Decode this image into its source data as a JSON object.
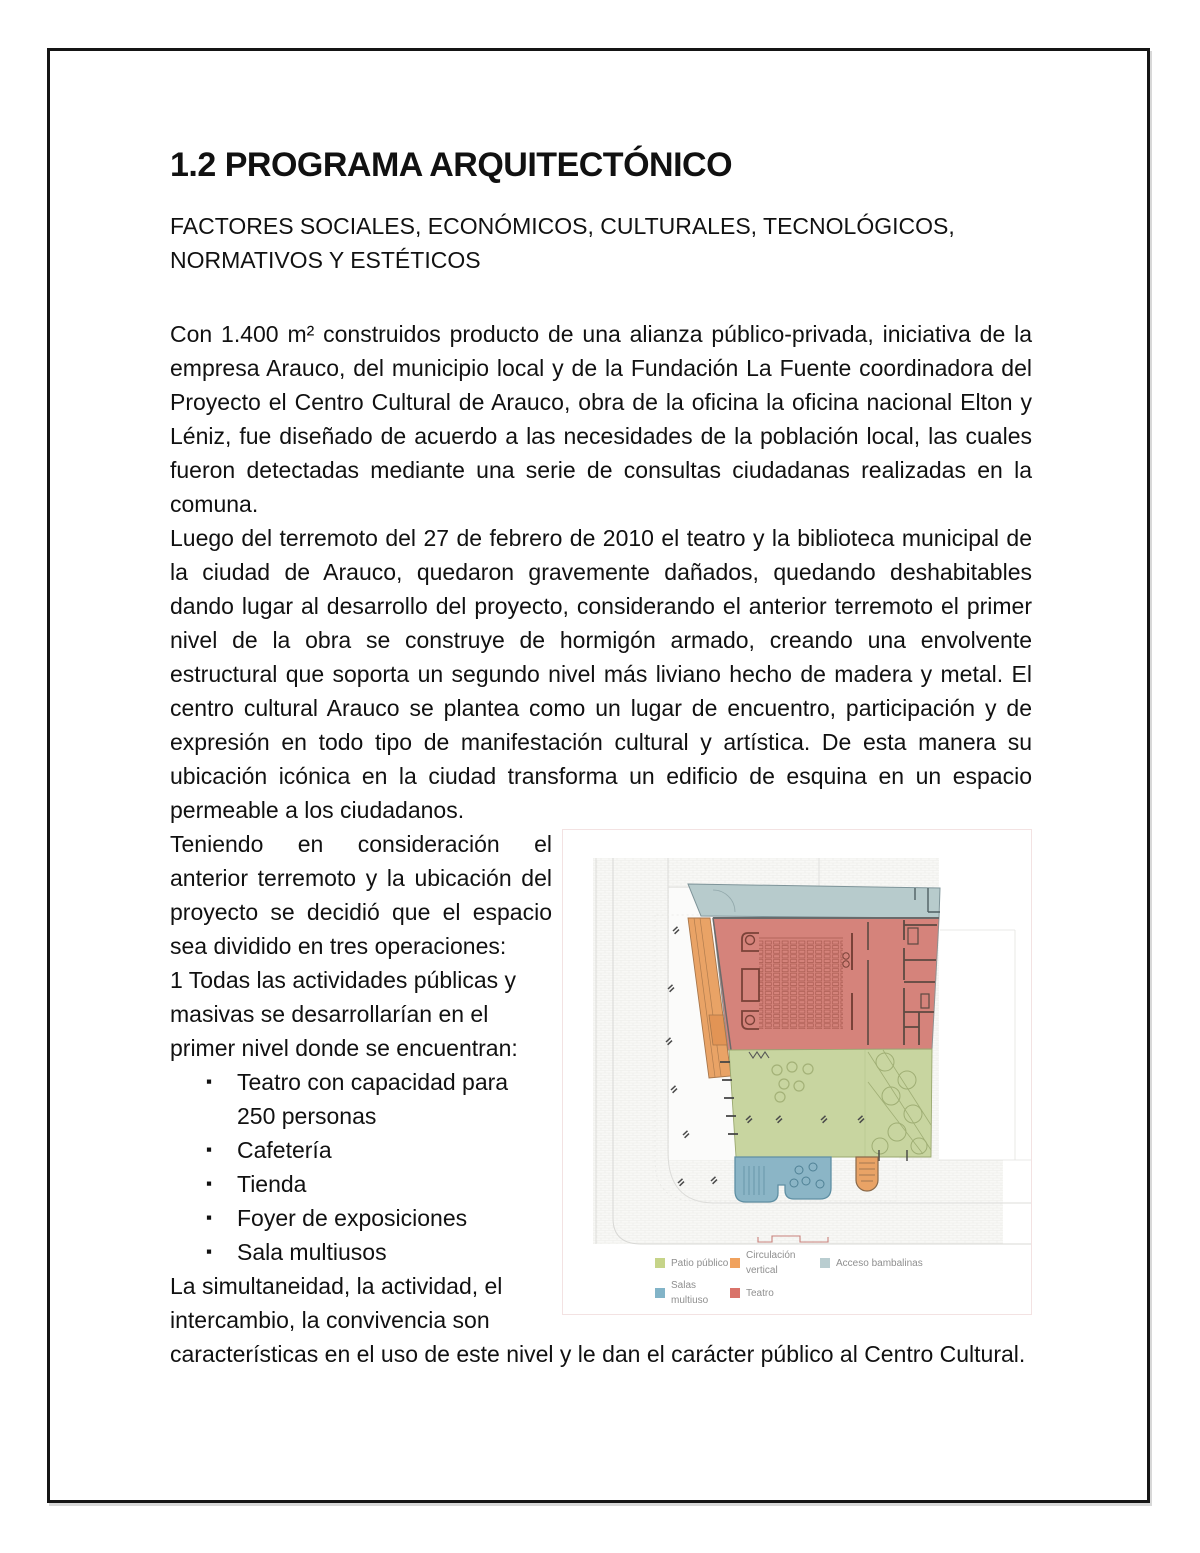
{
  "page": {
    "title": "1.2 PROGRAMA ARQUITECTÓNICO",
    "subtitle": "FACTORES SOCIALES, ECONÓMICOS, CULTURALES, TECNOLÓGICOS, NORMATIVOS Y ESTÉTICOS",
    "paragraphs": {
      "p1": "Con 1.400 m² construidos producto de una alianza público-privada, iniciativa de la empresa Arauco, del municipio local y de la Fundación La Fuente coordinadora del Proyecto el Centro Cultural de Arauco, obra de la oficina la oficina nacional Elton y Léniz, fue diseñado de acuerdo a las necesidades de la población local, las cuales fueron detectadas mediante una serie de consultas ciudadanas realizadas en la comuna.",
      "p2": "Luego del terremoto del 27 de febrero de 2010 el teatro y la biblioteca municipal de la ciudad de Arauco, quedaron gravemente dañados, quedando deshabitables dando lugar al desarrollo del proyecto, considerando el anterior terremoto el primer nivel de la obra se construye de hormigón armado, creando una envolvente estructural que soporta un segundo nivel más liviano hecho de madera y metal. El centro cultural Arauco se plantea como un lugar de encuentro, participación y de expresión en todo tipo de manifestación cultural y artística. De esta manera su ubicación icónica en la ciudad transforma un edificio de esquina en un espacio permeable a los ciudadanos.",
      "p3": "Teniendo en consideración el anterior terremoto y la ubicación del proyecto se decidió que el espacio sea dividido en tres operaciones:",
      "p4": "1 Todas las actividades públicas y masivas se desarrollarían en el primer nivel donde se encuentran:",
      "p5": "La simultaneidad, la actividad, el intercambio, la convivencia son características en el uso de este nivel y le dan el carácter público al Centro Cultural."
    },
    "bullets": [
      "Teatro con capacidad para 250 personas",
      "Cafetería",
      "Tienda",
      "Foyer de exposiciones",
      "Sala multiusos"
    ]
  },
  "figure": {
    "zones": {
      "patio": "#c8d5a0",
      "circulacion": "#e9a366",
      "circulacion_landing": "#e29455",
      "bambalinas": "#b7cbcc",
      "salas": "#8bb5c6",
      "teatro": "#d5837b"
    },
    "legend": [
      {
        "label": "Patio público",
        "color": "#c6d489"
      },
      {
        "label": "Circulación vertical",
        "color": "#f0a25e"
      },
      {
        "label": "Acceso bambalinas",
        "color": "#b9cdd0"
      },
      {
        "label": "Salas multiuso",
        "color": "#82b4c8"
      },
      {
        "label": "Teatro",
        "color": "#d9736a"
      }
    ]
  }
}
